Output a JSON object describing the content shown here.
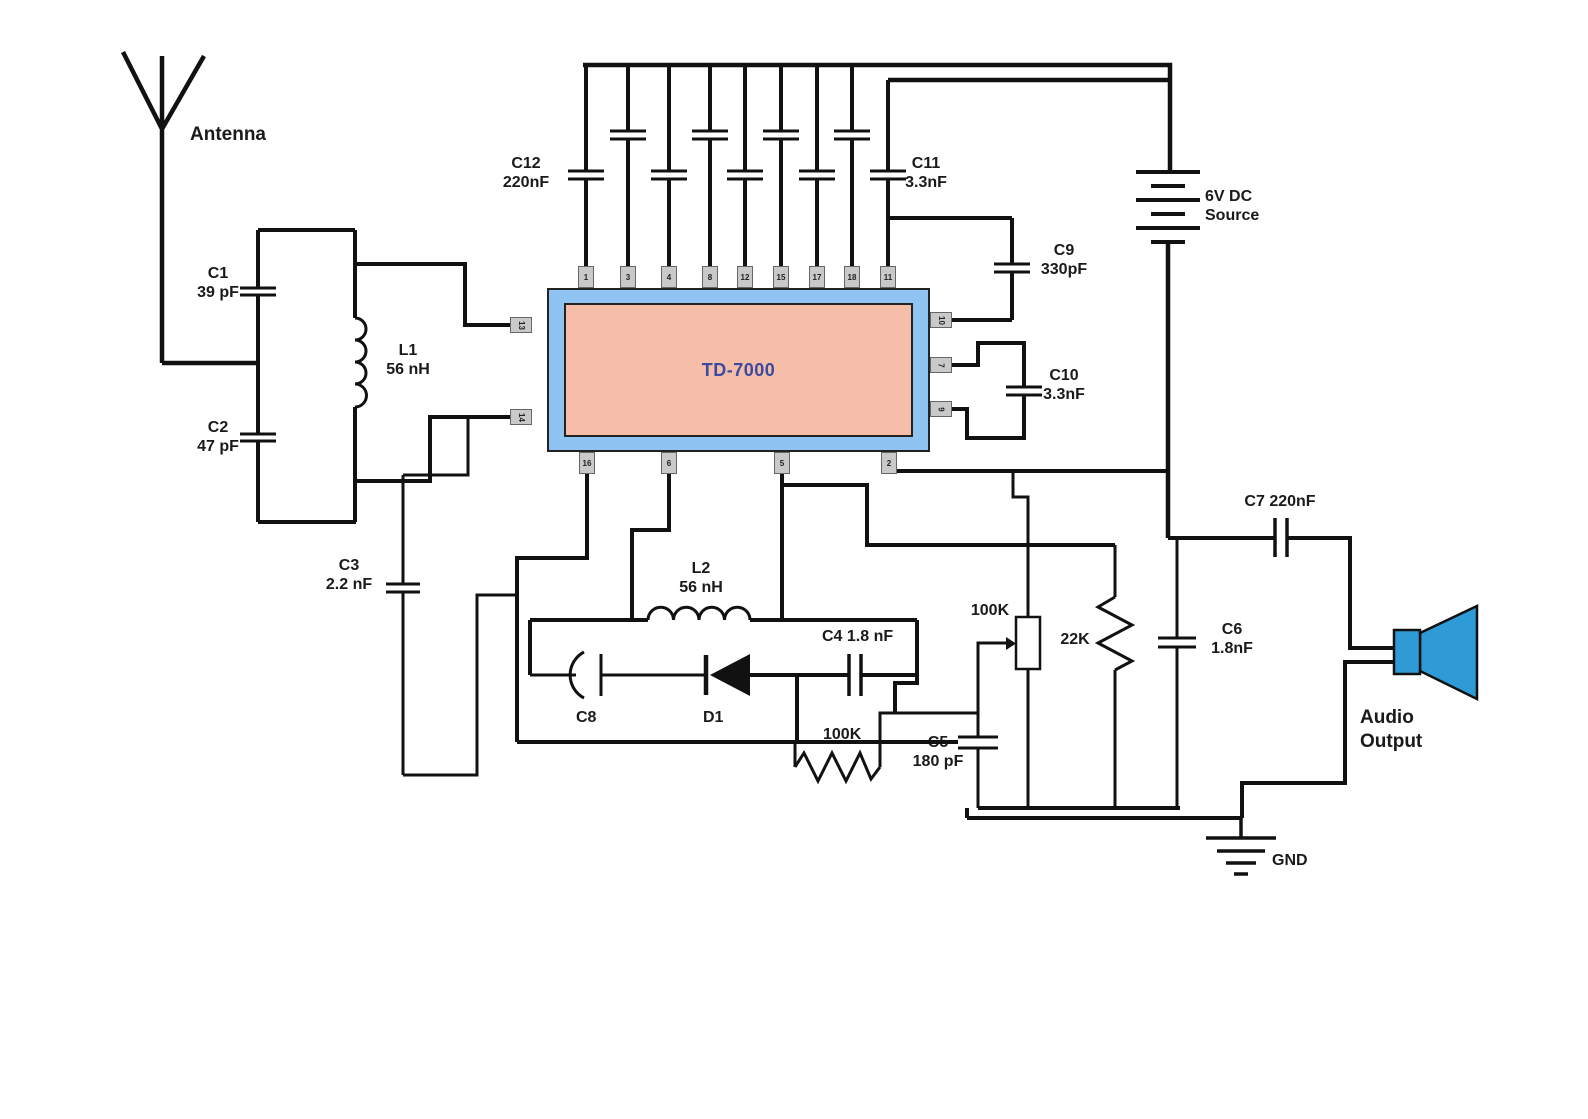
{
  "diagram": {
    "antenna_label": "Antenna",
    "ic": {
      "label": "TD-7000",
      "pins_top": [
        "1",
        "3",
        "4",
        "8",
        "12",
        "15",
        "17",
        "18",
        "11"
      ],
      "pins_left": [
        "13",
        "14"
      ],
      "pins_right": [
        "10",
        "7",
        "9"
      ],
      "pins_bottom": [
        "16",
        "6",
        "5",
        "2"
      ]
    },
    "components": {
      "c1": {
        "name": "C1",
        "value": "39 pF"
      },
      "c2": {
        "name": "C2",
        "value": "47 pF"
      },
      "c3": {
        "name": "C3",
        "value": "2.2 nF"
      },
      "l1": {
        "name": "L1",
        "value": "56 nH"
      },
      "c12": {
        "name": "C12",
        "value": "220nF"
      },
      "c11": {
        "name": "C11",
        "value": "3.3nF"
      },
      "c9": {
        "name": "C9",
        "value": "330pF"
      },
      "c10": {
        "name": "C10",
        "value": "3.3nF"
      },
      "battery": {
        "name": "6V DC",
        "value": "Source"
      },
      "l2": {
        "name": "L2",
        "value": "56 nH"
      },
      "c8": {
        "name": "C8"
      },
      "d1": {
        "name": "D1"
      },
      "c4": {
        "name": "C4 1.8 nF"
      },
      "r1": {
        "name": "100K"
      },
      "c5": {
        "name": "C5",
        "value": "180 pF"
      },
      "pot": {
        "name": "100K"
      },
      "r2": {
        "name": "22K"
      },
      "c6": {
        "name": "C6",
        "value": "1.8nF"
      },
      "c7": {
        "name": "C7 220nF"
      },
      "speaker": {
        "name": "Audio",
        "value": "Output"
      },
      "gnd": {
        "name": "GND"
      }
    },
    "colors": {
      "wire": "#111111",
      "ic_body": "#8FC3F2",
      "ic_core": "#F6BDA8",
      "ic_text": "#3B4BA0",
      "pin_fill": "#C9C9C9",
      "speaker_blue": "#2E9BD6",
      "background": "#FFFFFF"
    }
  }
}
